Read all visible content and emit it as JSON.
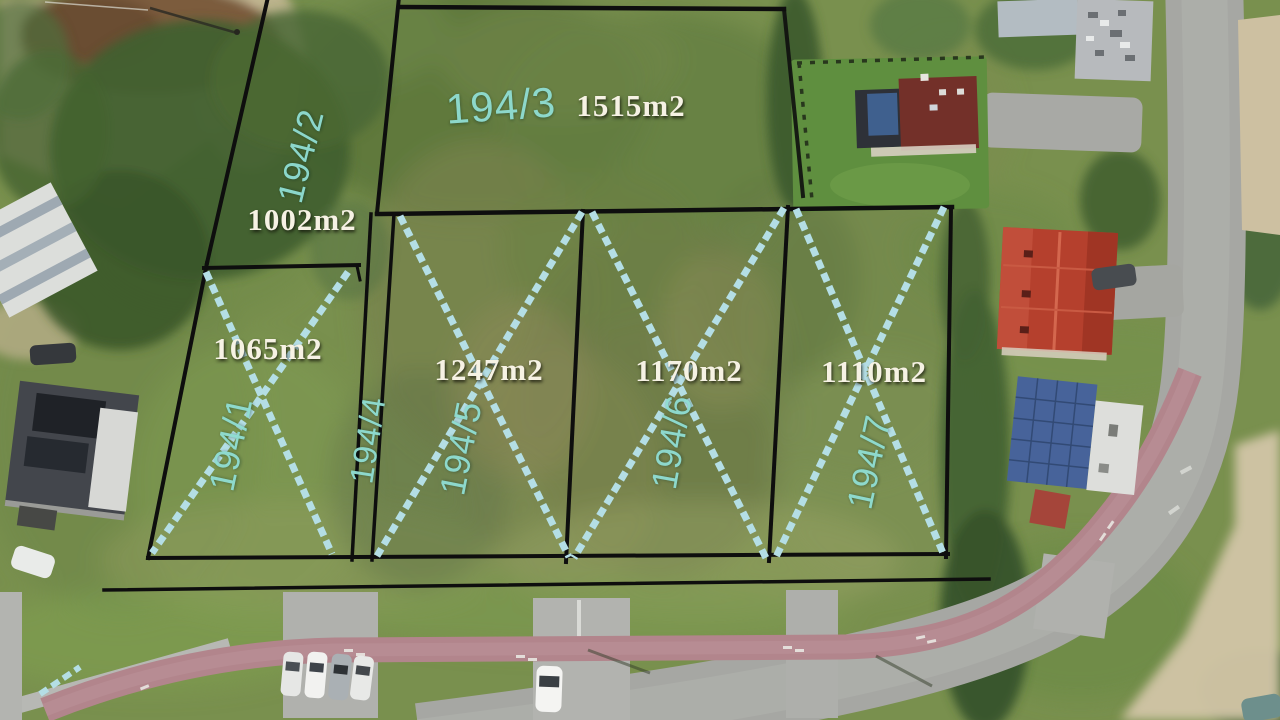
{
  "plots": [
    {
      "number": "194/1",
      "area": "1065m2",
      "crossed": true
    },
    {
      "number": "194/2",
      "area": "1002m2",
      "crossed": false
    },
    {
      "number": "194/3",
      "area": "1515m2",
      "crossed": false
    },
    {
      "number": "194/4",
      "area": "",
      "crossed": true
    },
    {
      "number": "194/5",
      "area": "1247m2",
      "crossed": true
    },
    {
      "number": "194/6",
      "area": "1170m2",
      "crossed": true
    },
    {
      "number": "194/7",
      "area": "1110m2",
      "crossed": true
    }
  ],
  "annotation_colors": {
    "plot_number_text": "#8fdcd2",
    "area_label_text": "#f6f2e4",
    "boundary_line": "#0e0e0e",
    "cross_mark": "#b4dee5"
  }
}
